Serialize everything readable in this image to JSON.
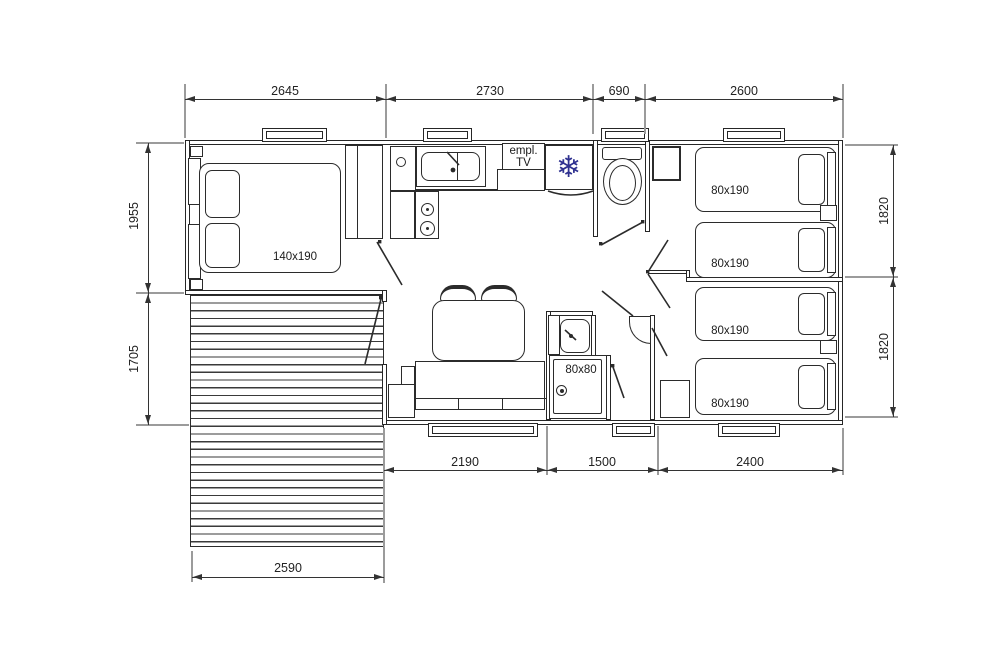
{
  "title": "Mobile home floor plan with deck",
  "colors": {
    "line": "#2b2b2b",
    "dimension": "#333333",
    "extension": "#9b9b9b",
    "snowflake": "#2f3190",
    "background": "#ffffff"
  },
  "dimensions": {
    "top": [
      "2645",
      "2730",
      "690",
      "2600"
    ],
    "left": [
      "1955",
      "1705"
    ],
    "right": [
      "1820",
      "1820"
    ],
    "bottom": [
      "2190",
      "1500",
      "2400"
    ],
    "deck": "2590"
  },
  "labels": {
    "master_bed": "140x190",
    "single_beds": [
      "80x190",
      "80x190",
      "80x190",
      "80x190"
    ],
    "shower": "80x80",
    "tv": [
      "empl.",
      "TV"
    ],
    "fridge_icon": "❄"
  }
}
